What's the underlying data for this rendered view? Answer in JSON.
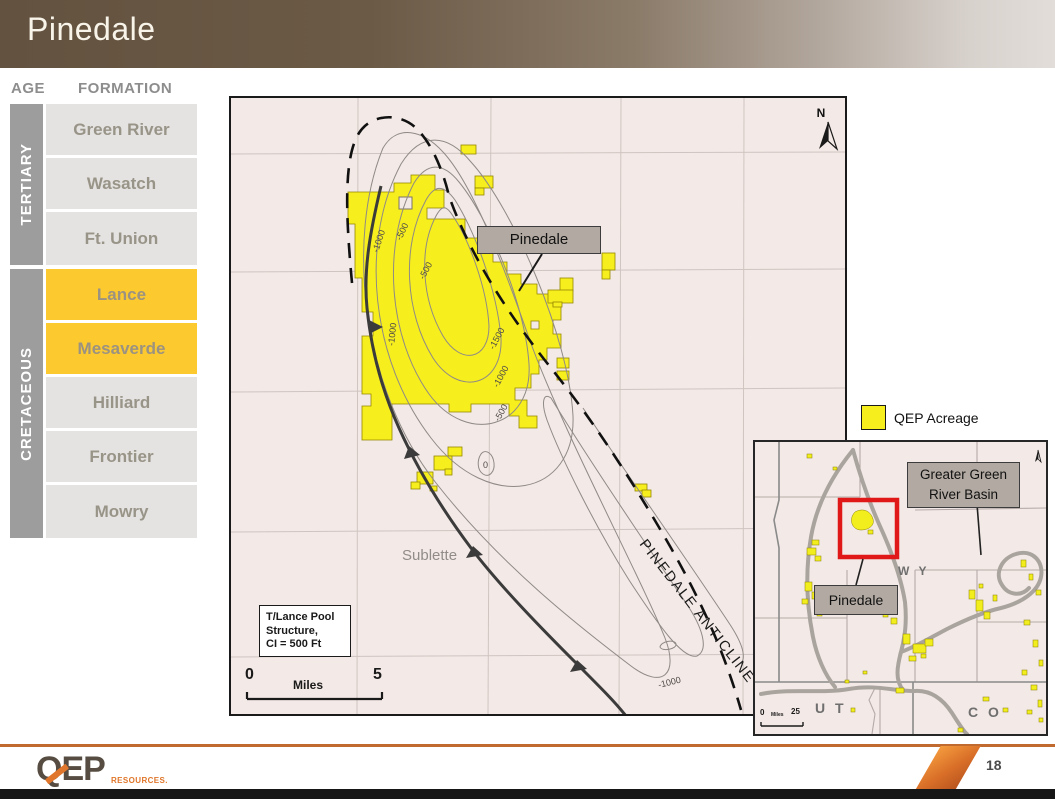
{
  "slide": {
    "title": "Pinedale",
    "page_number": "18"
  },
  "strat": {
    "age_header": "AGE",
    "formation_header": "FORMATION",
    "groups": [
      {
        "label": "TERTIARY"
      },
      {
        "label": "CRETACEOUS"
      }
    ],
    "formations": [
      {
        "label": "Green River",
        "group": "TERTIARY",
        "highlight": false
      },
      {
        "label": "Wasatch",
        "group": "TERTIARY",
        "highlight": false
      },
      {
        "label": "Ft. Union",
        "group": "TERTIARY",
        "highlight": false
      },
      {
        "label": "Lance",
        "group": "CRETACEOUS",
        "highlight": true
      },
      {
        "label": "Mesaverde",
        "group": "CRETACEOUS",
        "highlight": true
      },
      {
        "label": "Hilliard",
        "group": "CRETACEOUS",
        "highlight": false
      },
      {
        "label": "Frontier",
        "group": "CRETACEOUS",
        "highlight": false
      },
      {
        "label": "Mowry",
        "group": "CRETACEOUS",
        "highlight": false
      }
    ]
  },
  "map": {
    "pinedale_label": "Pinedale",
    "county_label": "Sublette",
    "anticline_label": "PINEDALE ANTICLINE",
    "north_label": "N",
    "structure_note": {
      "line1": "T/Lance Pool",
      "line2": "Structure,",
      "line3": "CI = 500 Ft"
    },
    "scale": {
      "start": "0",
      "end": "5",
      "unit": "Miles"
    },
    "contour_labels": [
      "-1000",
      "-500",
      "-500",
      "-1000",
      "-1500",
      "-1000",
      "-500",
      "0",
      "-1000"
    ]
  },
  "legend": {
    "qep_acreage_label": "QEP Acreage"
  },
  "inset": {
    "basin_label_line1": "Greater Green",
    "basin_label_line2": "River Basin",
    "pinedale_label": "Pinedale",
    "states": {
      "wy": "W Y",
      "ut": "U T",
      "co": "C O"
    },
    "scale": {
      "start": "0",
      "end": "25",
      "unit": "Miles"
    }
  },
  "footer": {
    "logo_text": "QEP",
    "logo_subtext": "RESOURCES.",
    "page_number": "18"
  },
  "colors": {
    "header_gradient_start": "#63523f",
    "header_gradient_end": "#e2ddd9",
    "acreage_yellow": "#f7ee1e",
    "strat_highlight_yellow": "#fcca2f",
    "map_background": "#f3e9e6",
    "label_box_gray": "#b2aaa2",
    "highlight_red": "#e01818",
    "accent_orange": "#e0762b",
    "footer_rule_orange": "#c06a30"
  }
}
